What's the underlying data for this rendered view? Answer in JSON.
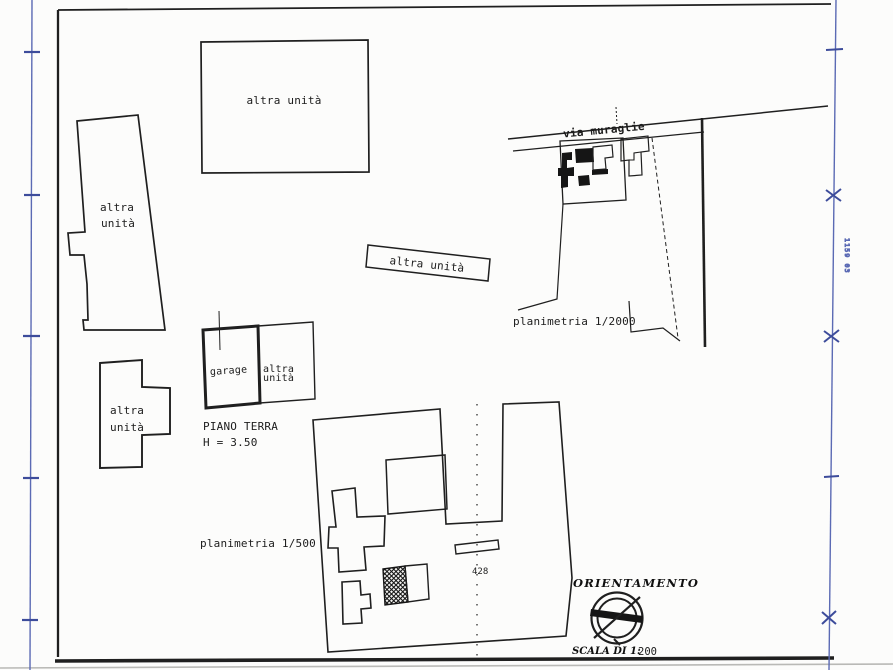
{
  "drawing": {
    "colors": {
      "ink": "#1f1f1f",
      "ruler_blue": "#5b6ab4",
      "ruler_mark_blue": "#3d4c9b"
    },
    "units": {
      "top": "altra unità",
      "left1": "altra",
      "left2": "unità",
      "strip": "altra unità",
      "garage": "garage",
      "beside1": "altra",
      "beside2": "unità",
      "lower1": "altra",
      "lower2": "unità"
    },
    "floor": {
      "line1": "PIANO TERRA",
      "line2": "H = 3.50"
    },
    "road_label": "via muraglie",
    "plan_2000_label": "planimetria 1/2000",
    "plan_500_label": "planimetria 1/500",
    "parcel_number": "428",
    "orientation": {
      "title": "ORIENTAMENTO",
      "scale_label": "SCALA DI 1:",
      "scale_value": "200"
    },
    "edge_note": "1159 03"
  }
}
